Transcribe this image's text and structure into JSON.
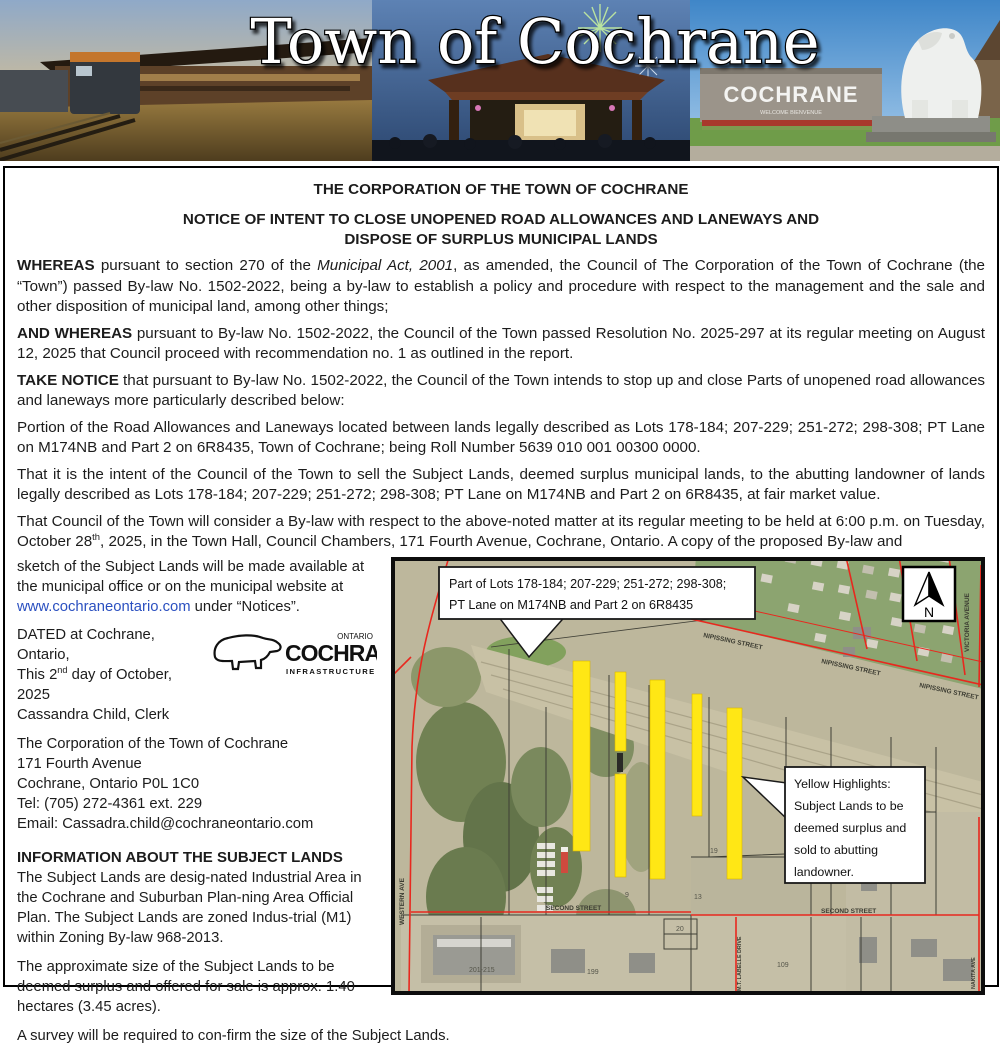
{
  "banner": {
    "title": "Town of Cochrane",
    "sign_text": "COCHRANE",
    "sign_sub": "WELCOME   BIENVENUE"
  },
  "notice": {
    "heading1": "THE CORPORATION OF THE TOWN OF COCHRANE",
    "heading2_line1": "NOTICE OF INTENT TO CLOSE UNOPENED ROAD ALLOWANCES AND LANEWAYS AND",
    "heading2_line2": "DISPOSE OF SURPLUS MUNICIPAL LANDS",
    "para_whereas": {
      "lead": "WHEREAS",
      "pre_italic": " pursuant to section 270 of the ",
      "italic": "Municipal Act, 2001",
      "post": ", as amended, the Council of The Corporation of the Town of Cochrane (the “Town”) passed By-law No. 1502-2022, being a by-law to establish a policy and procedure with respect to the management and the sale and other disposition of municipal land, among other things;"
    },
    "para_and_whereas": {
      "lead": "AND WHEREAS",
      "text": " pursuant to By-law No. 1502-2022, the Council of the Town passed Resolution No. 2025-297 at its regular meeting on August 12, 2025 that Council proceed with recommendation no. 1 as outlined in the report."
    },
    "para_take_notice": {
      "lead": "TAKE NOTICE",
      "text": " that pursuant to By-law No. 1502-2022, the Council of the Town intends to stop up and close Parts of unopened road allowances and laneways more particularly described below:"
    },
    "para_portion": "Portion of the Road Allowances and Laneways located between lands legally described as Lots 178-184; 207-229; 251-272; 298-308; PT Lane on M174NB and Part 2 on 6R8435, Town of Cochrane; being Roll Number 5639 010 001 00300 0000.",
    "para_intent": "That it is the intent of the Council of the Town to sell the Subject Lands, deemed surplus municipal lands, to the abutting landowner of lands legally described as Lots 178-184; 207-229; 251-272; 298-308; PT Lane on M174NB and Part 2 on 6R8435, at fair market value.",
    "para_meeting": {
      "part1": "That Council of the Town will consider a By-law with respect to the above-noted matter at its regular meeting to be held at 6:00 p.m. on Tuesday, October 28",
      "sup": "th",
      "part2": ", 2025, in the Town Hall, Council Chambers, 171 Fourth Avenue, Cochrane, Ontario. A copy of the proposed By-law and"
    },
    "para_sketch": {
      "part1": "sketch of the Subject Lands will be made available at the municipal office or on the municipal website at ",
      "link": "www.cochraneontario.com",
      "part2": " under “Notices”."
    }
  },
  "dated": {
    "line1": "DATED at Cochrane, Ontario,",
    "line2_pre": "This 2",
    "line2_sup": "nd",
    "line2_post": " day of October, 2025",
    "line3": "Cassandra Child, Clerk"
  },
  "logo": {
    "ontario": "ONTARIO",
    "name": "COCHRANE",
    "tagline": "INFRASTRUCTURE SERVICES"
  },
  "contact": {
    "line1": "The Corporation of the Town of Cochrane",
    "line2": "171 Fourth Avenue",
    "line3": "Cochrane, Ontario P0L 1C0",
    "line4": "Tel: (705) 272-4361 ext. 229",
    "line5": "Email: Cassadra.child@cochraneontario.com"
  },
  "info": {
    "heading": "INFORMATION ABOUT THE SUBJECT LANDS",
    "para1": "The Subject Lands are desig-nated Industrial Area in the Cochrane and Suburban Plan-ning Area Official Plan. The Subject Lands are zoned Indus-trial (M1) within Zoning By-law 968-2013.",
    "para2": "The approximate size of the Subject Lands to be deemed surplus and offered for sale is approx. 1.40 hectares (3.45 acres).",
    "para3": "A survey will be required to con-firm the size of the Subject Lands."
  },
  "map": {
    "callout_lots": {
      "line1": "Part of Lots 178-184; 207-229; 251-272; 298-308;",
      "line2": "PT Lane on M174NB and Part 2 on 6R8435"
    },
    "callout_yellow": {
      "line1": "Yellow Highlights:",
      "line2": "Subject Lands to be",
      "line3": "deemed surplus and",
      "line4": "sold to abutting",
      "line5": "landowner."
    },
    "north_label": "N",
    "streets": {
      "nipissing": "NIPISSING STREET",
      "victoria": "VICTORIA AVENUE",
      "western": "WESTERN AVE",
      "second": "SECOND STREET",
      "labelle": "M.T. LABELLE DRIVE",
      "nakita": "NAKITA AVE"
    },
    "lots": {
      "a": "9",
      "b": "13",
      "c": "19",
      "d": "20",
      "e": "199",
      "f": "201-215",
      "g": "109"
    },
    "colors": {
      "highlight_yellow": "#FFE715",
      "road_red": "#E8281E",
      "link_blue": "#2B50C0"
    }
  }
}
